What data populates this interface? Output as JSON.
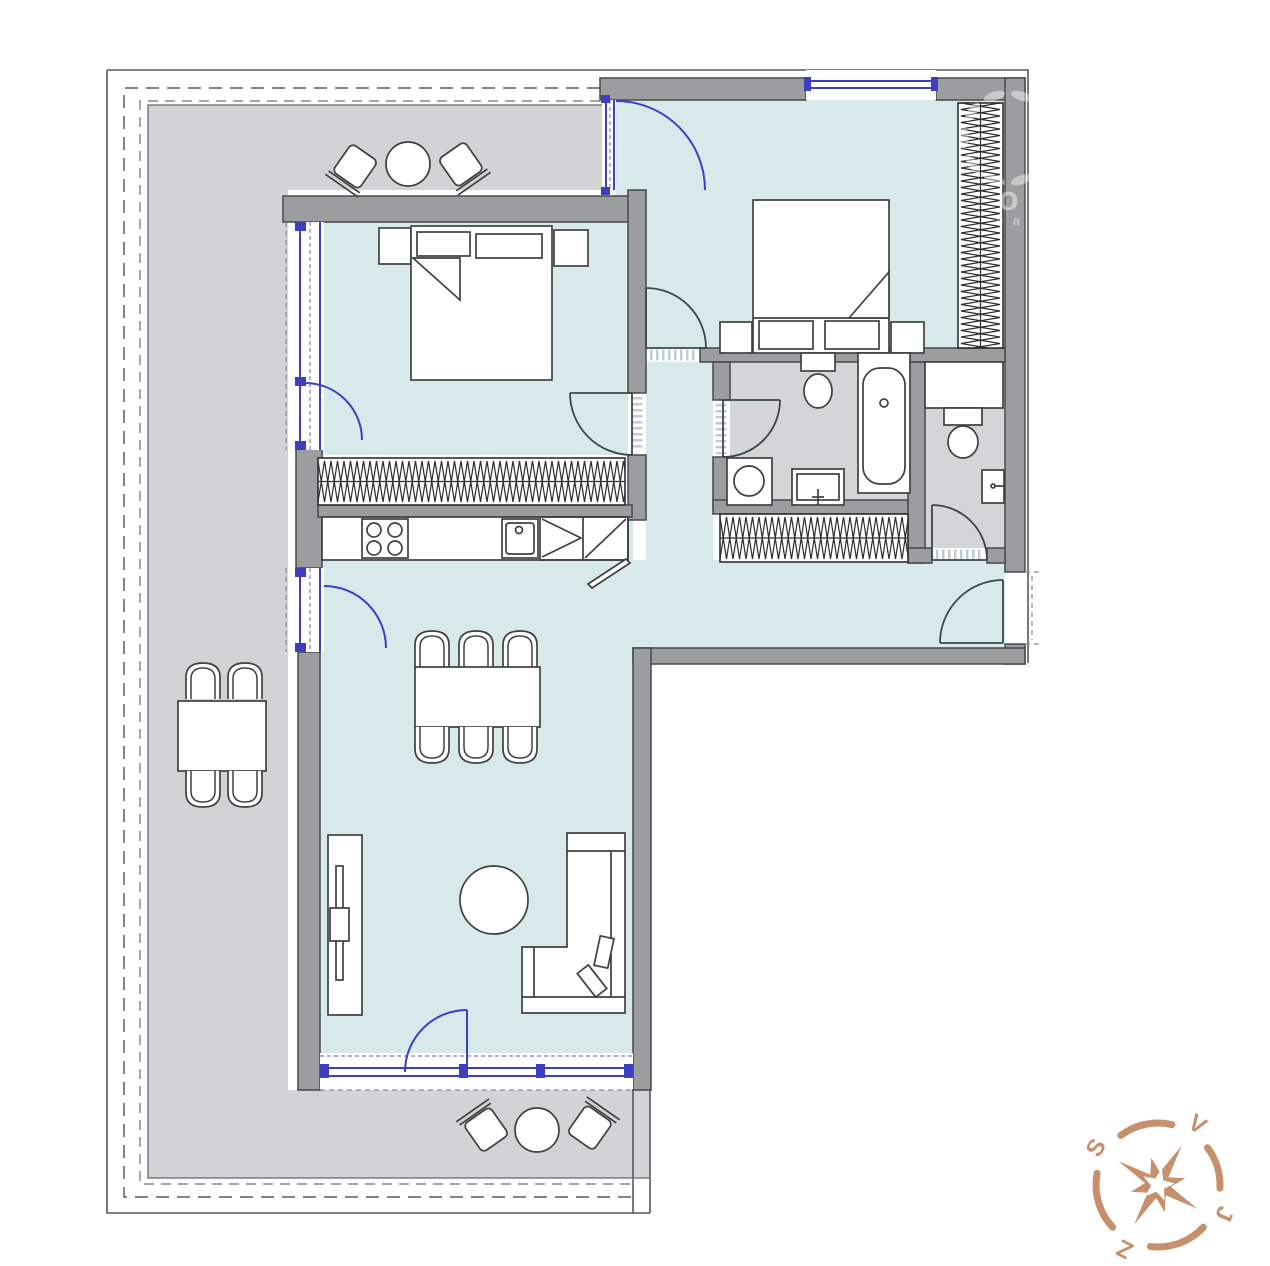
{
  "canvas": {
    "width": 1270,
    "height": 1266
  },
  "plan": {
    "type": "apartment-floor-plan",
    "colors": {
      "room_floor": "#d7e9ea",
      "terrace_floor": "#d2d3d4",
      "bathroom_floor": "#d4d5d6",
      "wall_fill": "#9c9d9e",
      "wall_outline": "#47484a",
      "glazing_blue": "#3c3fc0",
      "interior_door_arc": "#3a474b",
      "furniture_outline": "#3f4040",
      "compass_accent": "#c6906c"
    }
  },
  "compass": {
    "north_label": "S",
    "east_label": "V",
    "south_label": "J",
    "west_label": "Z"
  },
  "watermark": {
    "letter": "o",
    "fragment": "e a"
  }
}
